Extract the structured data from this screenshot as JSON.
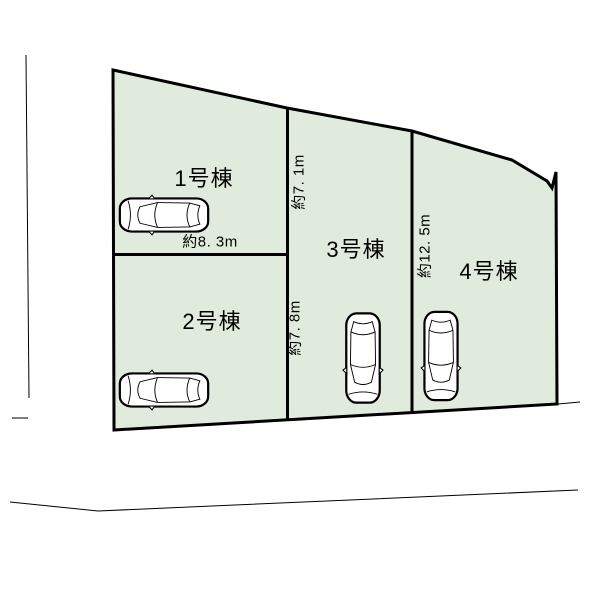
{
  "colors": {
    "background": "#ffffff",
    "lot_fill": "#e0ebdd",
    "line": "#000000",
    "car_fill": "#ffffff"
  },
  "lots": [
    {
      "label": "1号棟"
    },
    {
      "label": "2号棟"
    },
    {
      "label": "3号棟"
    },
    {
      "label": "4号棟"
    }
  ],
  "measurements": {
    "lot1_frontage": "約8. 3m",
    "lot3_upper_depth": "約7. 1m",
    "lot3_lower_depth": "約7. 8m",
    "lot4_depth": "約12. 5m"
  },
  "icons": {
    "car": "car-top-view-icon"
  }
}
